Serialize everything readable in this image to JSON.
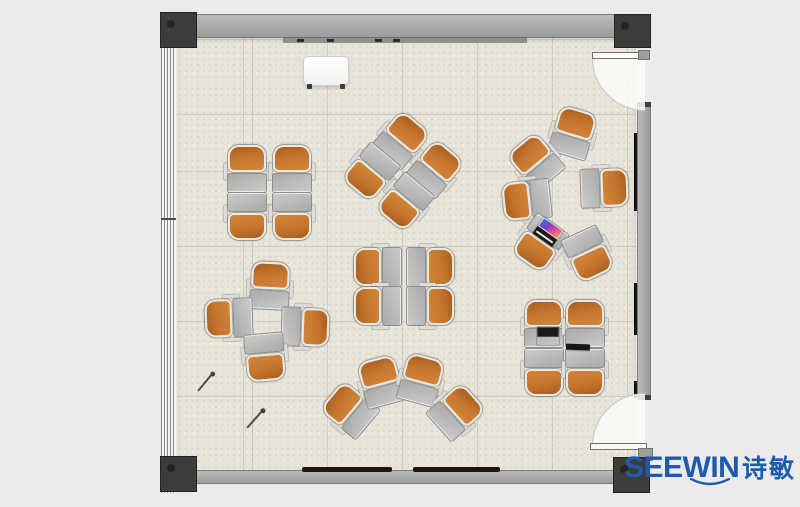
{
  "brand": {
    "wordmark": "SEEWIN",
    "cjk": "诗敏"
  },
  "palette": {
    "background": "#ebebeb",
    "floor": "#e8e4d8",
    "wall": "#a8a8a8",
    "column": "#3d3c3a",
    "seat_orange": "#c4762e",
    "desk_gray": "#b8b8b8",
    "brand": "#1e5bac"
  },
  "floorplan": {
    "room": "classroom training layout, top-down plan",
    "seat_total": 30,
    "clusters": [
      {
        "name": "two-by-two-front-facing",
        "units": [
          {
            "x": 247,
            "y": 169,
            "rot": 180
          },
          {
            "x": 292,
            "y": 169,
            "rot": 180
          },
          {
            "x": 247,
            "y": 216,
            "rot": 0
          },
          {
            "x": 292,
            "y": 216,
            "rot": 0
          }
        ]
      },
      {
        "name": "two-by-two-rotated-45",
        "units": [
          {
            "x": 401,
            "y": 140,
            "rot": 220
          },
          {
            "x": 435,
            "y": 169,
            "rot": 220
          },
          {
            "x": 371,
            "y": 172,
            "rot": 40
          },
          {
            "x": 405,
            "y": 202,
            "rot": 40
          }
        ]
      },
      {
        "name": "circle-of-six",
        "units": [
          {
            "x": 573,
            "y": 133,
            "rot": 197
          },
          {
            "x": 536,
            "y": 162,
            "rot": 140
          },
          {
            "x": 527,
            "y": 200,
            "rot": 84
          },
          {
            "x": 604,
            "y": 188,
            "rot": 268
          },
          {
            "x": 540,
            "y": 243,
            "rot": 35
          },
          {
            "x": 588,
            "y": 254,
            "rot": 335
          }
        ]
      },
      {
        "name": "pinwheel-of-four",
        "units": [
          {
            "x": 270,
            "y": 286,
            "rot": 183
          },
          {
            "x": 229,
            "y": 318,
            "rot": 88
          },
          {
            "x": 305,
            "y": 327,
            "rot": 272
          },
          {
            "x": 265,
            "y": 357,
            "rot": 355
          }
        ]
      },
      {
        "name": "two-by-two-inward-facing",
        "units": [
          {
            "x": 378,
            "y": 267,
            "rot": 90
          },
          {
            "x": 430,
            "y": 267,
            "rot": 270
          },
          {
            "x": 378,
            "y": 306,
            "rot": 90
          },
          {
            "x": 430,
            "y": 306,
            "rot": 270
          }
        ]
      },
      {
        "name": "arc-of-four",
        "units": [
          {
            "x": 350,
            "y": 410,
            "rot": 130
          },
          {
            "x": 381,
            "y": 382,
            "rot": 165
          },
          {
            "x": 421,
            "y": 380,
            "rot": 195
          },
          {
            "x": 456,
            "y": 412,
            "rot": 228
          }
        ]
      },
      {
        "name": "two-by-two-with-laptops",
        "units": [
          {
            "x": 544,
            "y": 324,
            "rot": 180
          },
          {
            "x": 585,
            "y": 324,
            "rot": 180
          },
          {
            "x": 544,
            "y": 372,
            "rot": 0
          },
          {
            "x": 585,
            "y": 372,
            "rot": 0
          }
        ]
      }
    ],
    "props": [
      {
        "type": "whiteboard",
        "x": 303,
        "y": 56,
        "w": 46,
        "h": 30,
        "rot": 0
      },
      {
        "type": "laptop-open",
        "variant": "v1",
        "x": 537,
        "y": 327,
        "w": 22,
        "h": 18,
        "rot": 0
      },
      {
        "type": "laptop-open",
        "variant": "v2",
        "x": 536,
        "y": 222,
        "w": 24,
        "h": 20,
        "rot": 35
      },
      {
        "type": "tablet",
        "x": 566,
        "y": 344,
        "w": 24,
        "h": 6,
        "rot": 2
      },
      {
        "type": "pen",
        "x1": 198,
        "y1": 391,
        "x2": 213,
        "y2": 373
      },
      {
        "type": "pen",
        "x1": 247,
        "y1": 428,
        "x2": 263,
        "y2": 410
      }
    ]
  }
}
